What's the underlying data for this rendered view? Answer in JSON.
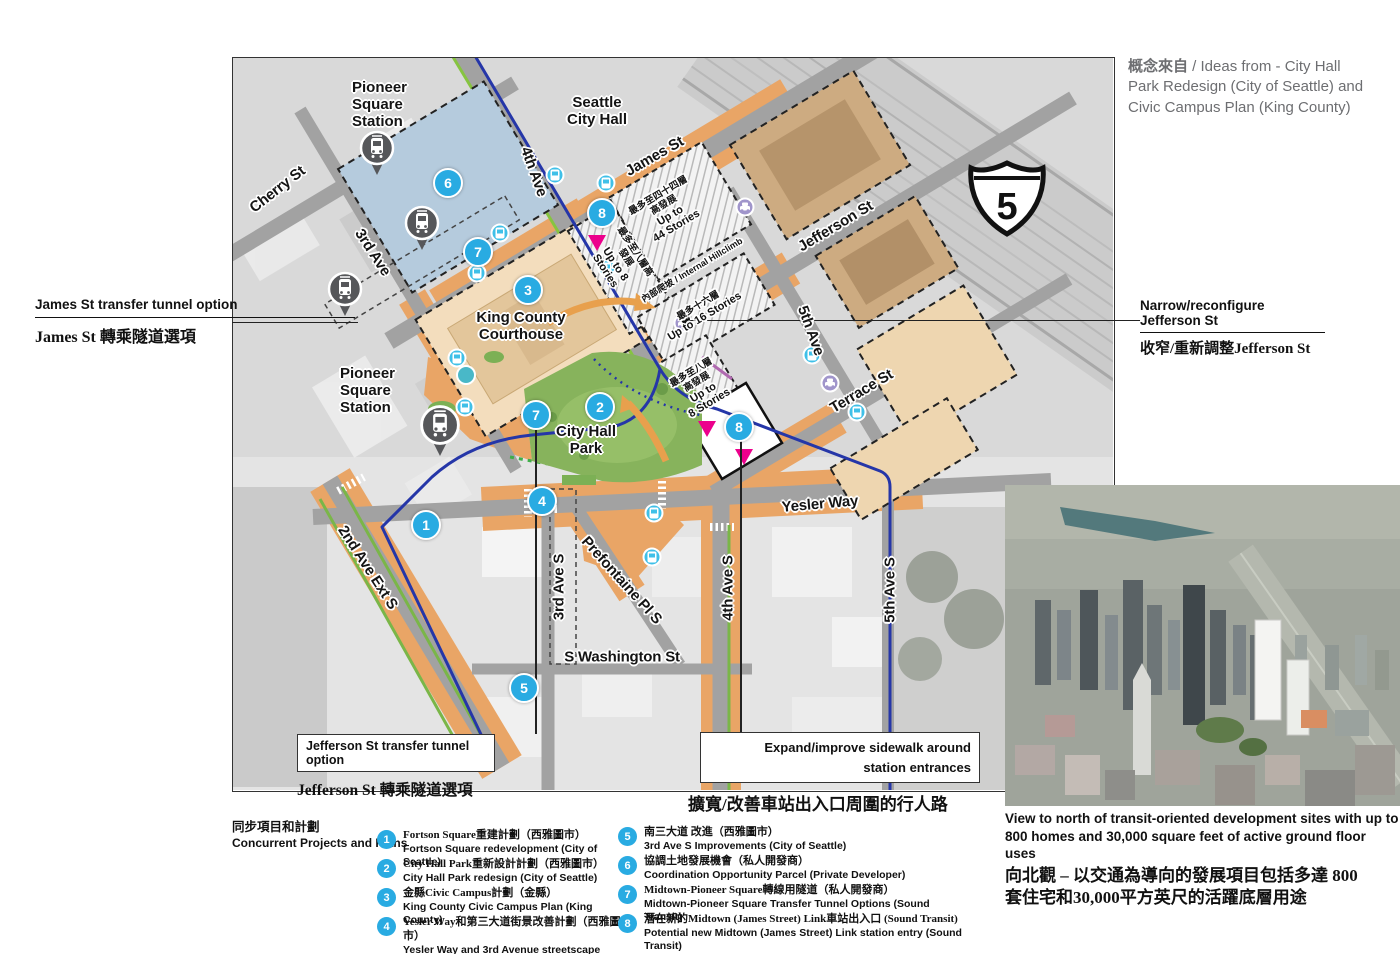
{
  "source_note": {
    "zh": "概念來自",
    "en": " / Ideas from - City Hall Park Redesign (City of Seattle) and Civic Campus Plan (King County)"
  },
  "map": {
    "interstate": {
      "number": "5"
    },
    "streets": {
      "cherry": "Cherry St",
      "third": "3rd Ave",
      "fourth": "4th Ave",
      "james": "James St",
      "jefferson": "Jefferson St",
      "fifth": "5th Ave",
      "terrace": "Terrace St",
      "yesler": "Yesler Way",
      "second_ext": "2nd Ave Ext S",
      "third_s": "3rd Ave S",
      "prefontaine": "Prefontaine Pl S",
      "fourth_s": "4th Ave S",
      "washington": "S Washington St",
      "fifth_s": "5th Ave S"
    },
    "places": {
      "pioneer_station": "Pioneer\nSquare\nStation",
      "city_hall": "Seattle\nCity Hall",
      "courthouse": "King County\nCourthouse",
      "park": "City Hall\nPark"
    },
    "buildings": {
      "b44": {
        "zh": "最多至四十四層高發展",
        "en": "Up to\n44 Stories"
      },
      "b16": {
        "zh": "最多十六層",
        "en": "Up to 16 Stories"
      },
      "b8w": {
        "zh": "最多至八層高發展",
        "en": "Up to 8 Stories"
      },
      "b8s": {
        "zh": "最多至八層\n高發展",
        "en": "Up to\n8 Stories"
      },
      "hillclimb": {
        "zh": "內部爬坡",
        "en": " / Internal Hillclimb"
      }
    },
    "badges": {
      "b1": "1",
      "b2": "2",
      "b3": "3",
      "b4": "4",
      "b5": "5",
      "b6": "6",
      "b7": "7",
      "b8": "8"
    }
  },
  "callouts": {
    "james_tunnel": {
      "en": "James St transfer tunnel option",
      "zh": "James St 轉乘隧道選項"
    },
    "narrow_jefferson": {
      "en": "Narrow/reconfigure Jefferson St",
      "zh": "收窄/重新調整Jefferson St"
    },
    "jefferson_tunnel": {
      "en": "Jefferson St transfer tunnel option",
      "zh": "Jefferson St 轉乘隧道選項"
    },
    "expand_sidewalk": {
      "en": "Expand/improve sidewalk around\nstation entrances",
      "zh": "擴寬/改善車站出入口周圍的行人路"
    }
  },
  "legend": {
    "title_zh": "同步項目和計劃",
    "title_en": "Concurrent Projects and Plans",
    "items": [
      {
        "num": "1",
        "zh": "Fortson Square重建計劃（西雅圖市）",
        "en": "Fortson Square redevelopment (City of Seattle)"
      },
      {
        "num": "2",
        "zh": "City Hall Park重新設計計劃（西雅圖市）",
        "en": "City Hall Park redesign (City of Seattle)"
      },
      {
        "num": "3",
        "zh": "金縣Civic Campus計劃（金縣）",
        "en": "King County Civic Campus Plan (King County)"
      },
      {
        "num": "4",
        "zh": "Yesler Way和第三大道街景改善計劃（西雅圖市）",
        "en": "Yesler Way and 3rd Avenue streetscape improvements\n(City of Seattle)"
      },
      {
        "num": "5",
        "zh": "南三大道 改進（西雅圖市）",
        "en": "3rd Ave S Improvements (City of Seattle)"
      },
      {
        "num": "6",
        "zh": "協調土地發展機會（私人開發商）",
        "en": "Coordination Opportunity Parcel (Private Developer)"
      },
      {
        "num": "7",
        "zh": "Midtown-Pioneer Square轉線用隧道（私人開發商）",
        "en": "Midtown-Pioneer Square Transfer Tunnel Options (Sound Transit)"
      },
      {
        "num": "8",
        "zh": "潛在新的Midtown (James Street) Link車站出入口 (Sound Transit)",
        "en": "Potential new Midtown (James Street) Link station entry (Sound Transit)"
      }
    ]
  },
  "inset": {
    "caption_en": "View to north of transit-oriented development sites with up to\n800 homes and 30,000 square feet of active ground floor uses",
    "caption_zh": "向北觀 – 以交通為導向的發展項目包括多達 800\n套住宅和30,000平方英尺的活躍底層用途"
  },
  "colors": {
    "badge_blue": "#29abe2",
    "entry_magenta": "#ec008c",
    "improvement_orange": "#e9a566",
    "parcel_blue": "#b5cbdd",
    "park_green": "#87b35c",
    "transit_blue": "#2536a8"
  }
}
